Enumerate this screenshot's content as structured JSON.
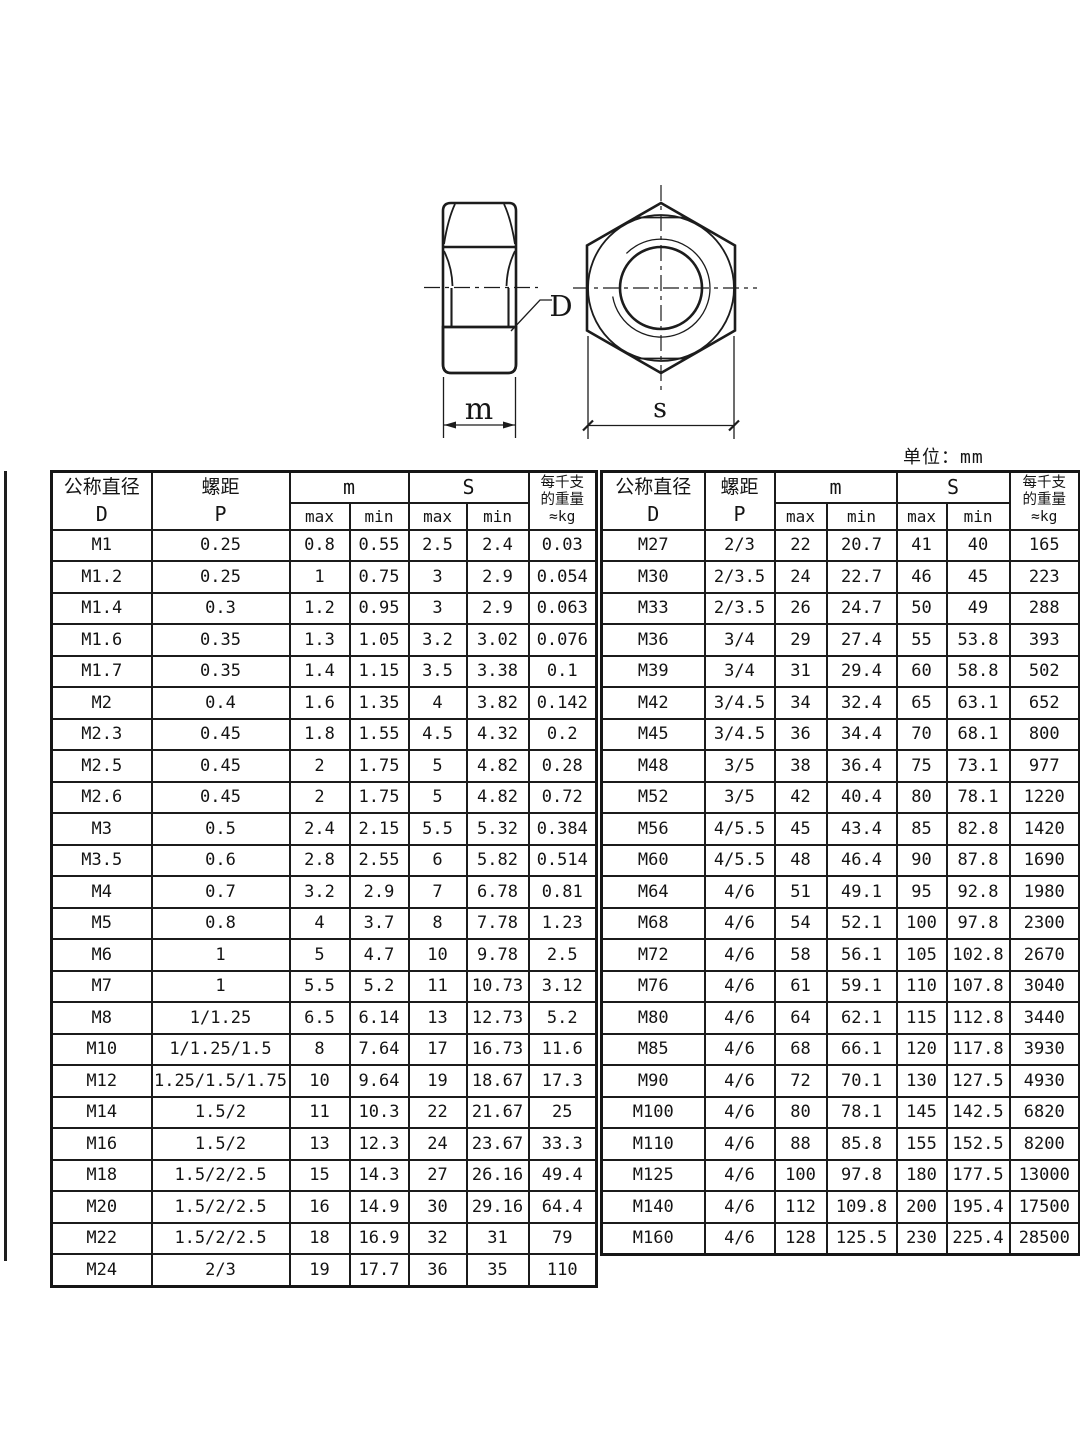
{
  "page": {
    "unit_label": "单位：mm"
  },
  "diagram": {
    "labels": {
      "bore": "D",
      "height": "m",
      "width_across_flats": "s"
    }
  },
  "table_headers": {
    "diameter_title": "公称直径",
    "diameter_symbol": "D",
    "pitch_title": "螺距",
    "pitch_symbol": "P",
    "m_group": "m",
    "s_group": "S",
    "max": "max",
    "min": "min",
    "weight_line1": "每千支",
    "weight_line2": "的重量",
    "weight_line3": "≈kg"
  },
  "left_table": {
    "rows": [
      [
        "M1",
        "0.25",
        "0.8",
        "0.55",
        "2.5",
        "2.4",
        "0.03"
      ],
      [
        "M1.2",
        "0.25",
        "1",
        "0.75",
        "3",
        "2.9",
        "0.054"
      ],
      [
        "M1.4",
        "0.3",
        "1.2",
        "0.95",
        "3",
        "2.9",
        "0.063"
      ],
      [
        "M1.6",
        "0.35",
        "1.3",
        "1.05",
        "3.2",
        "3.02",
        "0.076"
      ],
      [
        "M1.7",
        "0.35",
        "1.4",
        "1.15",
        "3.5",
        "3.38",
        "0.1"
      ],
      [
        "M2",
        "0.4",
        "1.6",
        "1.35",
        "4",
        "3.82",
        "0.142"
      ],
      [
        "M2.3",
        "0.45",
        "1.8",
        "1.55",
        "4.5",
        "4.32",
        "0.2"
      ],
      [
        "M2.5",
        "0.45",
        "2",
        "1.75",
        "5",
        "4.82",
        "0.28"
      ],
      [
        "M2.6",
        "0.45",
        "2",
        "1.75",
        "5",
        "4.82",
        "0.72"
      ],
      [
        "M3",
        "0.5",
        "2.4",
        "2.15",
        "5.5",
        "5.32",
        "0.384"
      ],
      [
        "M3.5",
        "0.6",
        "2.8",
        "2.55",
        "6",
        "5.82",
        "0.514"
      ],
      [
        "M4",
        "0.7",
        "3.2",
        "2.9",
        "7",
        "6.78",
        "0.81"
      ],
      [
        "M5",
        "0.8",
        "4",
        "3.7",
        "8",
        "7.78",
        "1.23"
      ],
      [
        "M6",
        "1",
        "5",
        "4.7",
        "10",
        "9.78",
        "2.5"
      ],
      [
        "M7",
        "1",
        "5.5",
        "5.2",
        "11",
        "10.73",
        "3.12"
      ],
      [
        "M8",
        "1/1.25",
        "6.5",
        "6.14",
        "13",
        "12.73",
        "5.2"
      ],
      [
        "M10",
        "1/1.25/1.5",
        "8",
        "7.64",
        "17",
        "16.73",
        "11.6"
      ],
      [
        "M12",
        "1.25/1.5/1.75",
        "10",
        "9.64",
        "19",
        "18.67",
        "17.3"
      ],
      [
        "M14",
        "1.5/2",
        "11",
        "10.3",
        "22",
        "21.67",
        "25"
      ],
      [
        "M16",
        "1.5/2",
        "13",
        "12.3",
        "24",
        "23.67",
        "33.3"
      ],
      [
        "M18",
        "1.5/2/2.5",
        "15",
        "14.3",
        "27",
        "26.16",
        "49.4"
      ],
      [
        "M20",
        "1.5/2/2.5",
        "16",
        "14.9",
        "30",
        "29.16",
        "64.4"
      ],
      [
        "M22",
        "1.5/2/2.5",
        "18",
        "16.9",
        "32",
        "31",
        "79"
      ],
      [
        "M24",
        "2/3",
        "19",
        "17.7",
        "36",
        "35",
        "110"
      ]
    ]
  },
  "right_table": {
    "rows": [
      [
        "M27",
        "2/3",
        "22",
        "20.7",
        "41",
        "40",
        "165"
      ],
      [
        "M30",
        "2/3.5",
        "24",
        "22.7",
        "46",
        "45",
        "223"
      ],
      [
        "M33",
        "2/3.5",
        "26",
        "24.7",
        "50",
        "49",
        "288"
      ],
      [
        "M36",
        "3/4",
        "29",
        "27.4",
        "55",
        "53.8",
        "393"
      ],
      [
        "M39",
        "3/4",
        "31",
        "29.4",
        "60",
        "58.8",
        "502"
      ],
      [
        "M42",
        "3/4.5",
        "34",
        "32.4",
        "65",
        "63.1",
        "652"
      ],
      [
        "M45",
        "3/4.5",
        "36",
        "34.4",
        "70",
        "68.1",
        "800"
      ],
      [
        "M48",
        "3/5",
        "38",
        "36.4",
        "75",
        "73.1",
        "977"
      ],
      [
        "M52",
        "3/5",
        "42",
        "40.4",
        "80",
        "78.1",
        "1220"
      ],
      [
        "M56",
        "4/5.5",
        "45",
        "43.4",
        "85",
        "82.8",
        "1420"
      ],
      [
        "M60",
        "4/5.5",
        "48",
        "46.4",
        "90",
        "87.8",
        "1690"
      ],
      [
        "M64",
        "4/6",
        "51",
        "49.1",
        "95",
        "92.8",
        "1980"
      ],
      [
        "M68",
        "4/6",
        "54",
        "52.1",
        "100",
        "97.8",
        "2300"
      ],
      [
        "M72",
        "4/6",
        "58",
        "56.1",
        "105",
        "102.8",
        "2670"
      ],
      [
        "M76",
        "4/6",
        "61",
        "59.1",
        "110",
        "107.8",
        "3040"
      ],
      [
        "M80",
        "4/6",
        "64",
        "62.1",
        "115",
        "112.8",
        "3440"
      ],
      [
        "M85",
        "4/6",
        "68",
        "66.1",
        "120",
        "117.8",
        "3930"
      ],
      [
        "M90",
        "4/6",
        "72",
        "70.1",
        "130",
        "127.5",
        "4930"
      ],
      [
        "M100",
        "4/6",
        "80",
        "78.1",
        "145",
        "142.5",
        "6820"
      ],
      [
        "M110",
        "4/6",
        "88",
        "85.8",
        "155",
        "152.5",
        "8200"
      ],
      [
        "M125",
        "4/6",
        "100",
        "97.8",
        "180",
        "177.5",
        "13000"
      ],
      [
        "M140",
        "4/6",
        "112",
        "109.8",
        "200",
        "195.4",
        "17500"
      ],
      [
        "M160",
        "4/6",
        "128",
        "125.5",
        "230",
        "225.4",
        "28500"
      ]
    ]
  }
}
